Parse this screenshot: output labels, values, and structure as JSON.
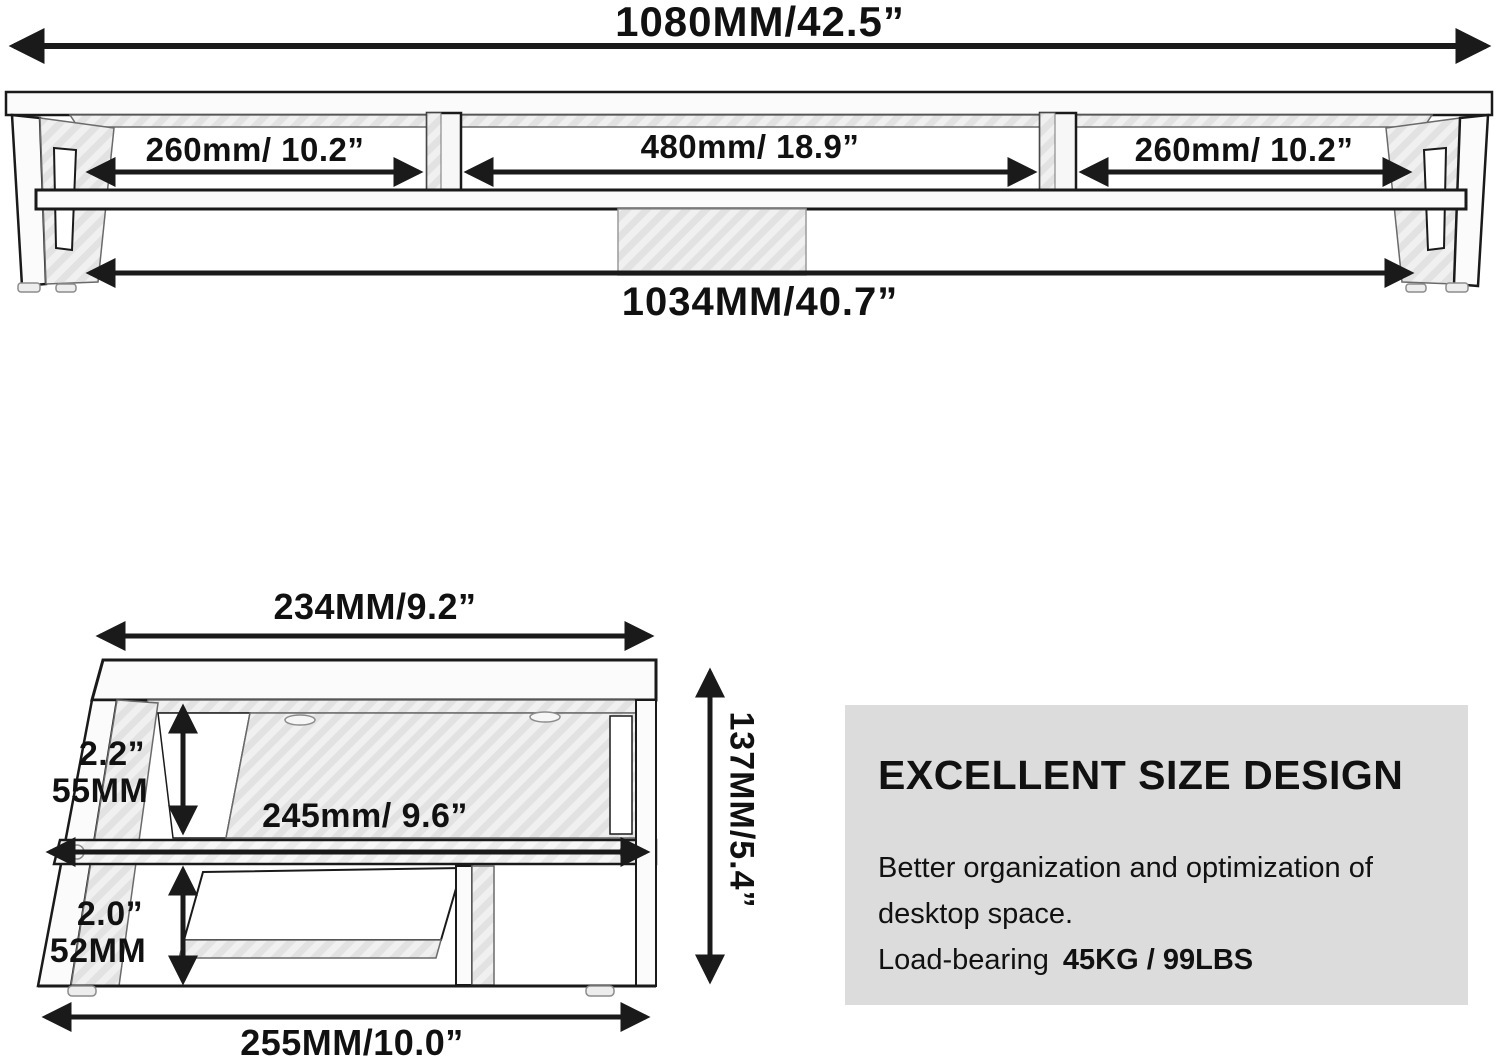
{
  "colors": {
    "line_color": "#1a1a1a",
    "text_color": "#111111",
    "panel_fill": "#f7f7f7",
    "hatch_base": "#f2f2f2",
    "hatch_stripe": "#e3e3e3",
    "info_box_bg": "#dcdcdc"
  },
  "top_view": {
    "total_width_top": "1080MM/42.5”",
    "sections": [
      "260mm/ 10.2”",
      "480mm/ 18.9”",
      "260mm/ 10.2”"
    ],
    "total_width_bottom": "1034MM/40.7”"
  },
  "side_view": {
    "top_width": "234MM/9.2”",
    "upper_clearance_in": "2.2”",
    "upper_clearance_mm": "55MM",
    "middle_width": "245mm/ 9.6”",
    "lower_clearance_in": "2.0”",
    "lower_clearance_mm": "52MM",
    "bottom_width": "255MM/10.0”",
    "height": "137MM/5.4”"
  },
  "info_box": {
    "title": "EXCELLENT SIZE DESIGN",
    "line1": "Better organization and optimization of",
    "line2": "desktop space.",
    "load_label": "Load-bearing",
    "load_value": "45KG / 99LBS"
  }
}
